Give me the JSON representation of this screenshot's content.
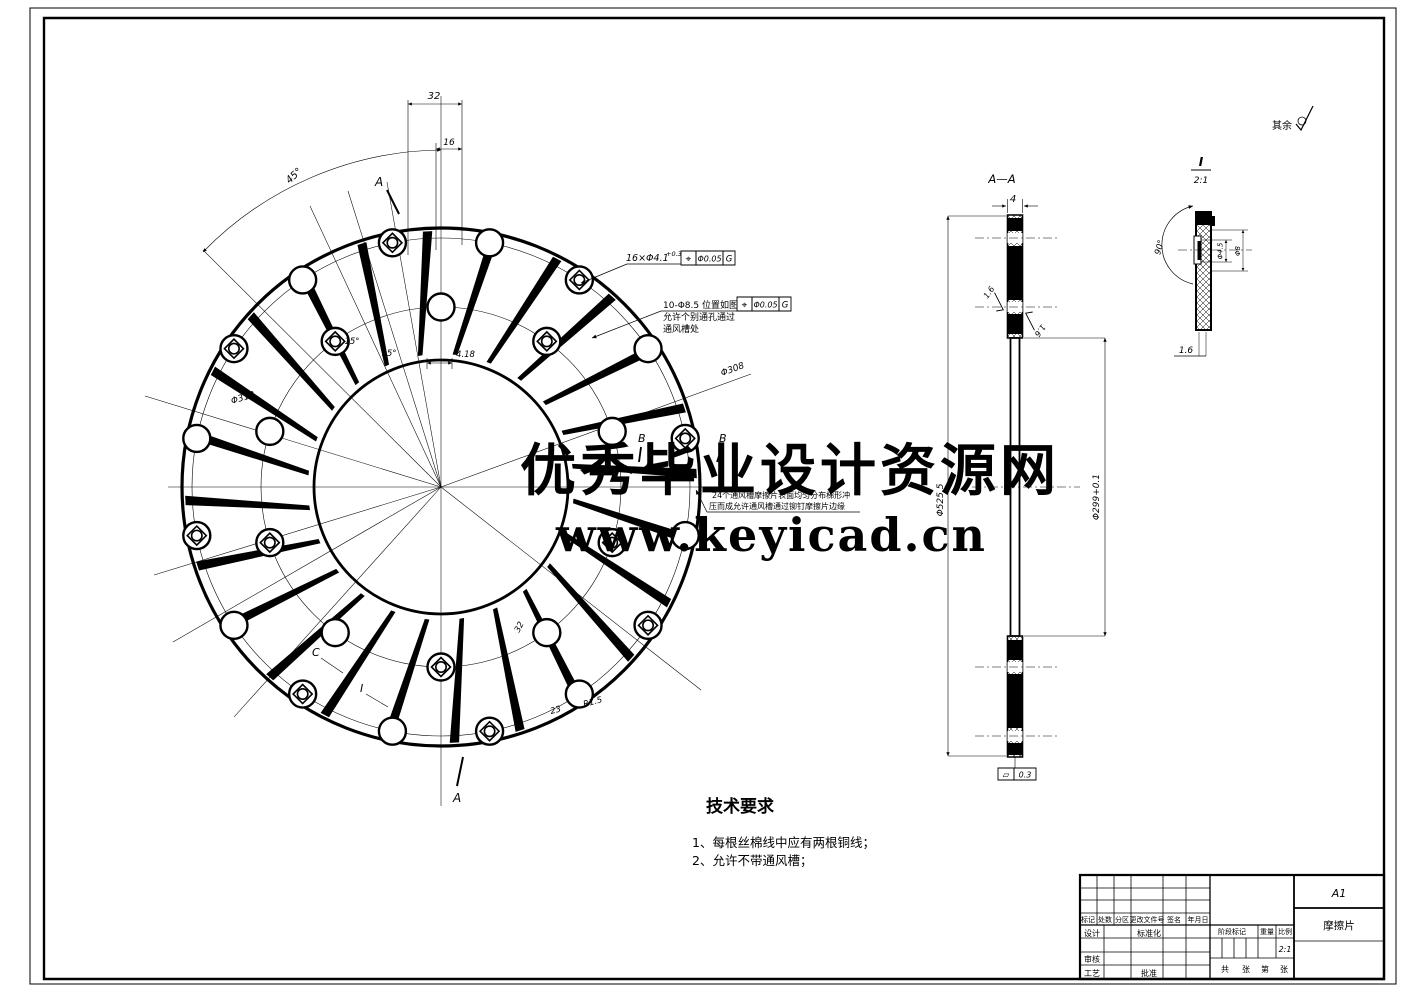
{
  "watermark": {
    "line1": "优秀毕业设计资源网",
    "line2": "www.keyicad.cn",
    "color": "#e42b20"
  },
  "sheet_note": {
    "label": "其余"
  },
  "plan": {
    "dim_32": "32",
    "dim_16": "16",
    "dim_45": "45°",
    "dim_15a": "15°",
    "dim_15b": "15°",
    "dim_418": "4.18",
    "dim_d308": "Φ308",
    "dim_d318": "Φ318",
    "dim_s32": "32",
    "dim_s23": "23",
    "dim_r15": "R1.5",
    "label_a_top": "A",
    "label_a_bottom": "A",
    "label_b1": "B",
    "label_b2": "B",
    "label_c": "C",
    "label_i": "I",
    "holes16": {
      "text": "16×Φ4.1",
      "sup": "+0.3",
      "gdt_sym": "⌖",
      "gdt_val": "Φ0.05",
      "gdt_ref": "G"
    },
    "holes10": {
      "line1": "10-Φ8.5 位置如图",
      "line2": "允许个别通孔通过",
      "line3": "通风槽处",
      "gdt_sym": "⌖",
      "gdt_val": "Φ0.05",
      "gdt_ref": "G"
    },
    "slots_note": {
      "line1": "24个通风槽摩擦片表面均匀分布梯形冲",
      "line2": "压而成允许通风槽通过铆钉摩擦片边缘"
    }
  },
  "section": {
    "title": "A—A",
    "dim_4": "4",
    "rough_l": "1.6",
    "rough_r": "1.6",
    "dim_outer": "Φ525.5",
    "dim_inner": "Φ299+0.1",
    "flat_sym": "▱",
    "flat_val": "0.3"
  },
  "detail": {
    "title": "I",
    "scale": "2:1",
    "angle": "90°",
    "dim_a": "Φ4.5",
    "dim_b": "Φ8",
    "dim_t": "1.6"
  },
  "tech": {
    "title": "技术要求",
    "item1": "1、每根丝棉线中应有两根铜线；",
    "item2": "2、允许不带通风槽；"
  },
  "tblock": {
    "sheet": "A1",
    "part": "摩擦片",
    "h_mark": "标记",
    "h_count": "处数",
    "h_zone": "分区",
    "h_doc": "更改文件号",
    "h_sign": "签名",
    "h_date": "年月日",
    "design": "设计",
    "standard": "标准化",
    "stage": "阶段标记",
    "weight": "重量",
    "ratio": "比例",
    "scale": "2:1",
    "check": "审核",
    "process": "工艺",
    "approve": "批准",
    "total": "共",
    "sheet_w": "张",
    "page": "第",
    "page_w": "张"
  }
}
